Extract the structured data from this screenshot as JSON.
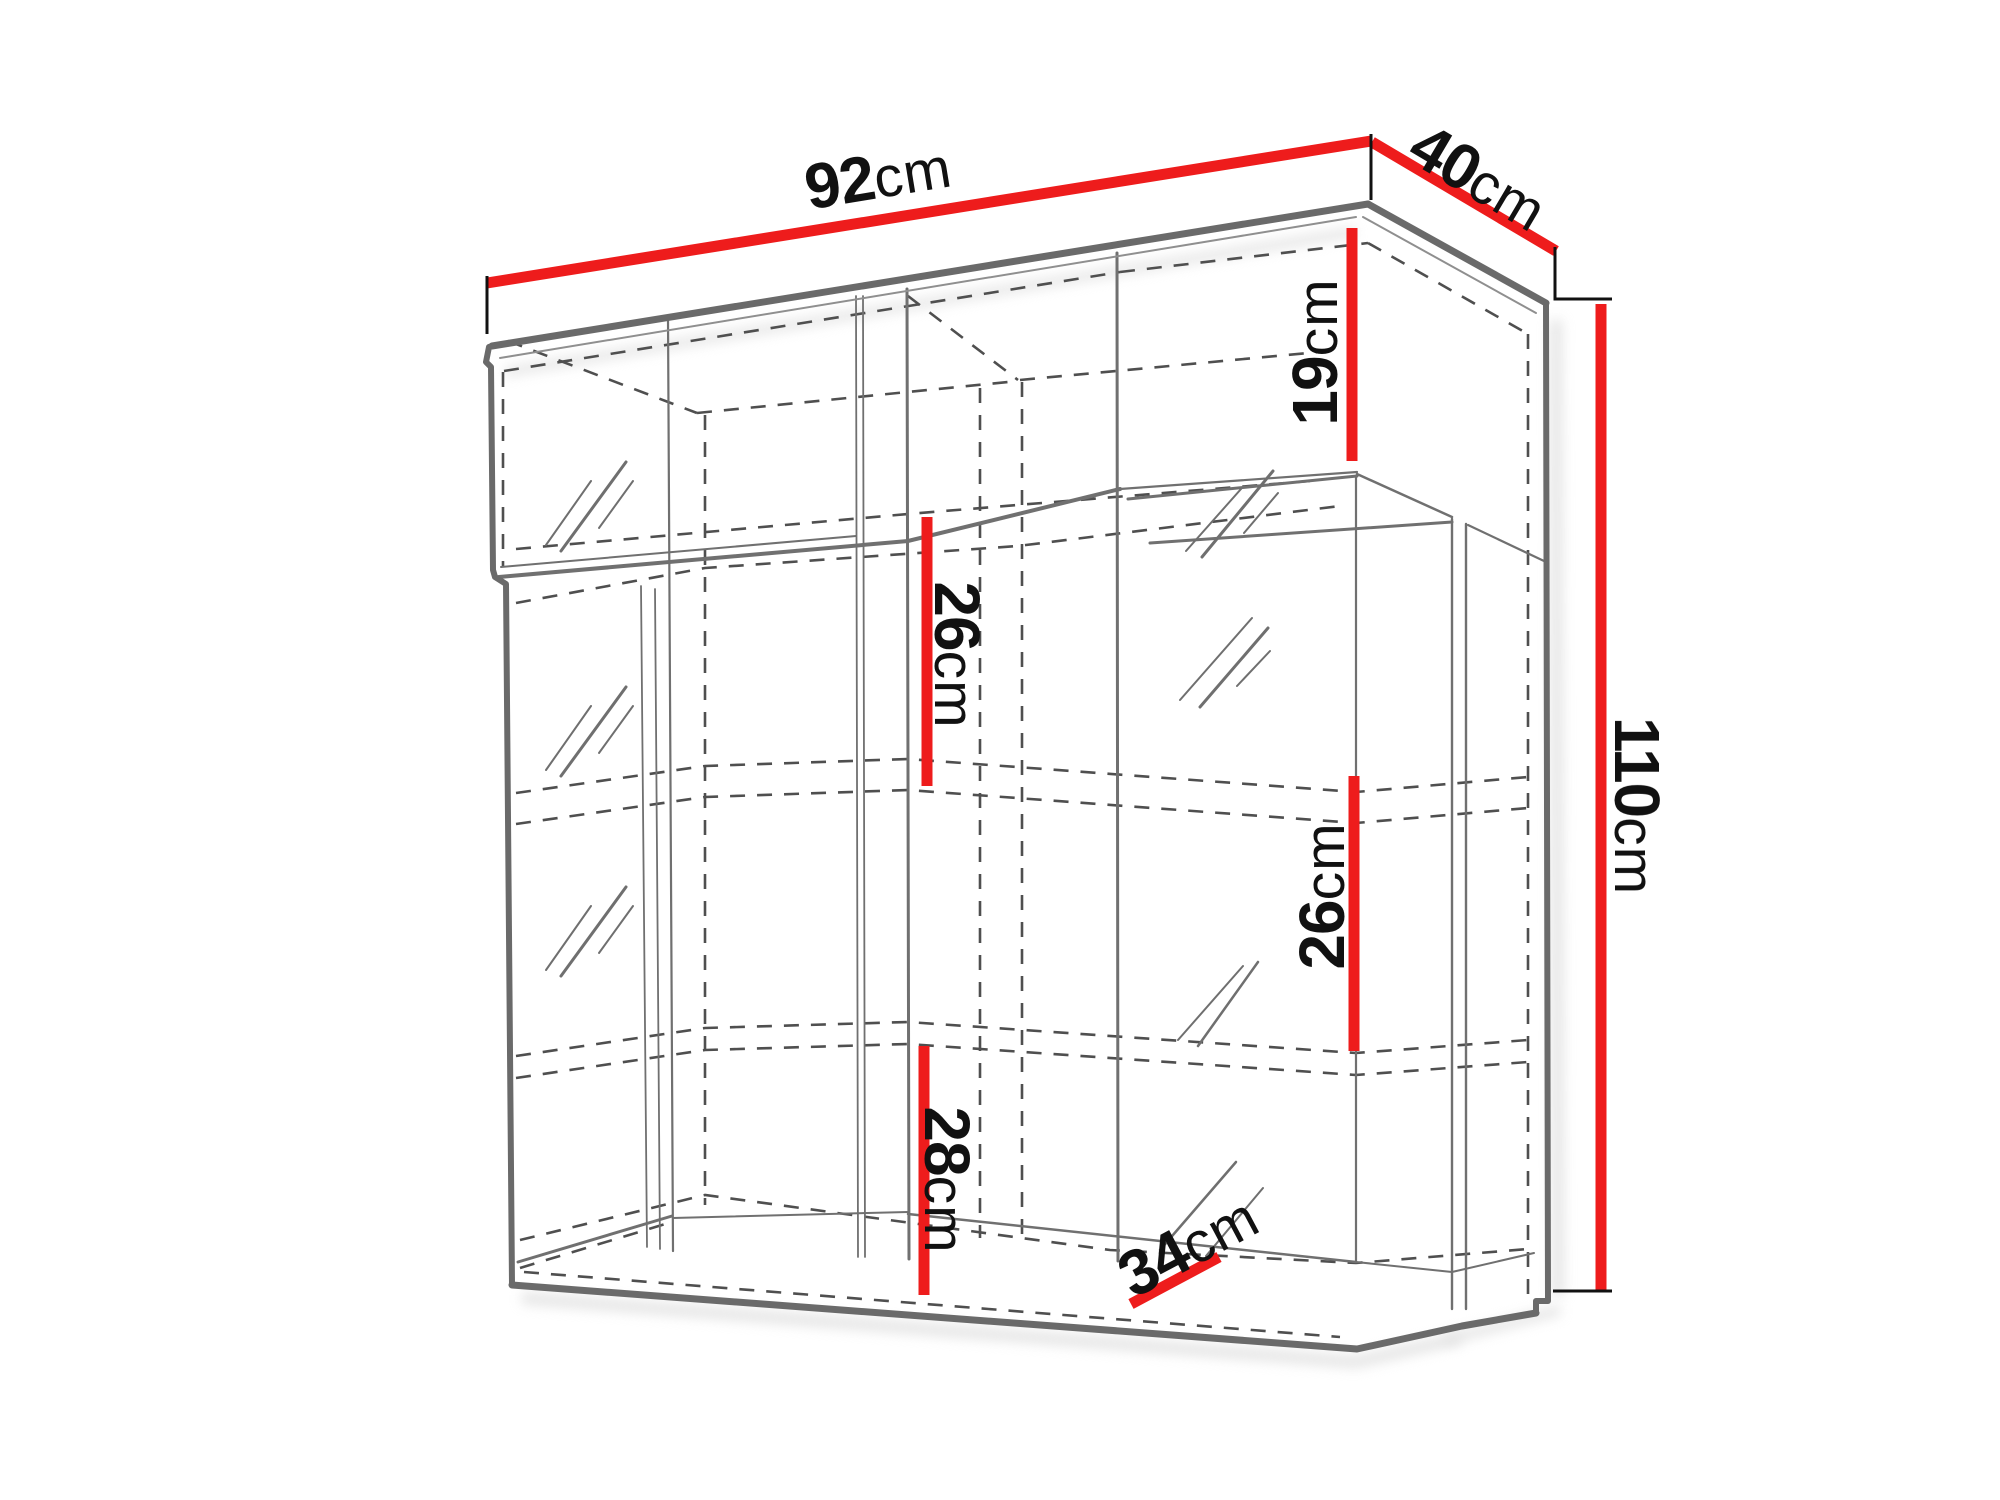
{
  "diagram": {
    "type": "furniture-dimension-drawing",
    "dimensions": {
      "top_width": {
        "value": "92",
        "unit": "cm"
      },
      "top_depth": {
        "value": "40",
        "unit": "cm"
      },
      "upper_compartment_height": {
        "value": "19",
        "unit": "cm"
      },
      "total_height": {
        "value": "110",
        "unit": "cm"
      },
      "middle_shelf_gap": {
        "value": "26",
        "unit": "cm"
      },
      "right_shelf_gap": {
        "value": "26",
        "unit": "cm"
      },
      "bottom_section_height": {
        "value": "28",
        "unit": "cm"
      },
      "interior_depth": {
        "value": "34",
        "unit": "cm"
      }
    },
    "colors": {
      "dimension_line": "#ee1c1c",
      "drawing_line": "#6a6a6a",
      "text": "#111111",
      "background": "#ffffff"
    }
  }
}
